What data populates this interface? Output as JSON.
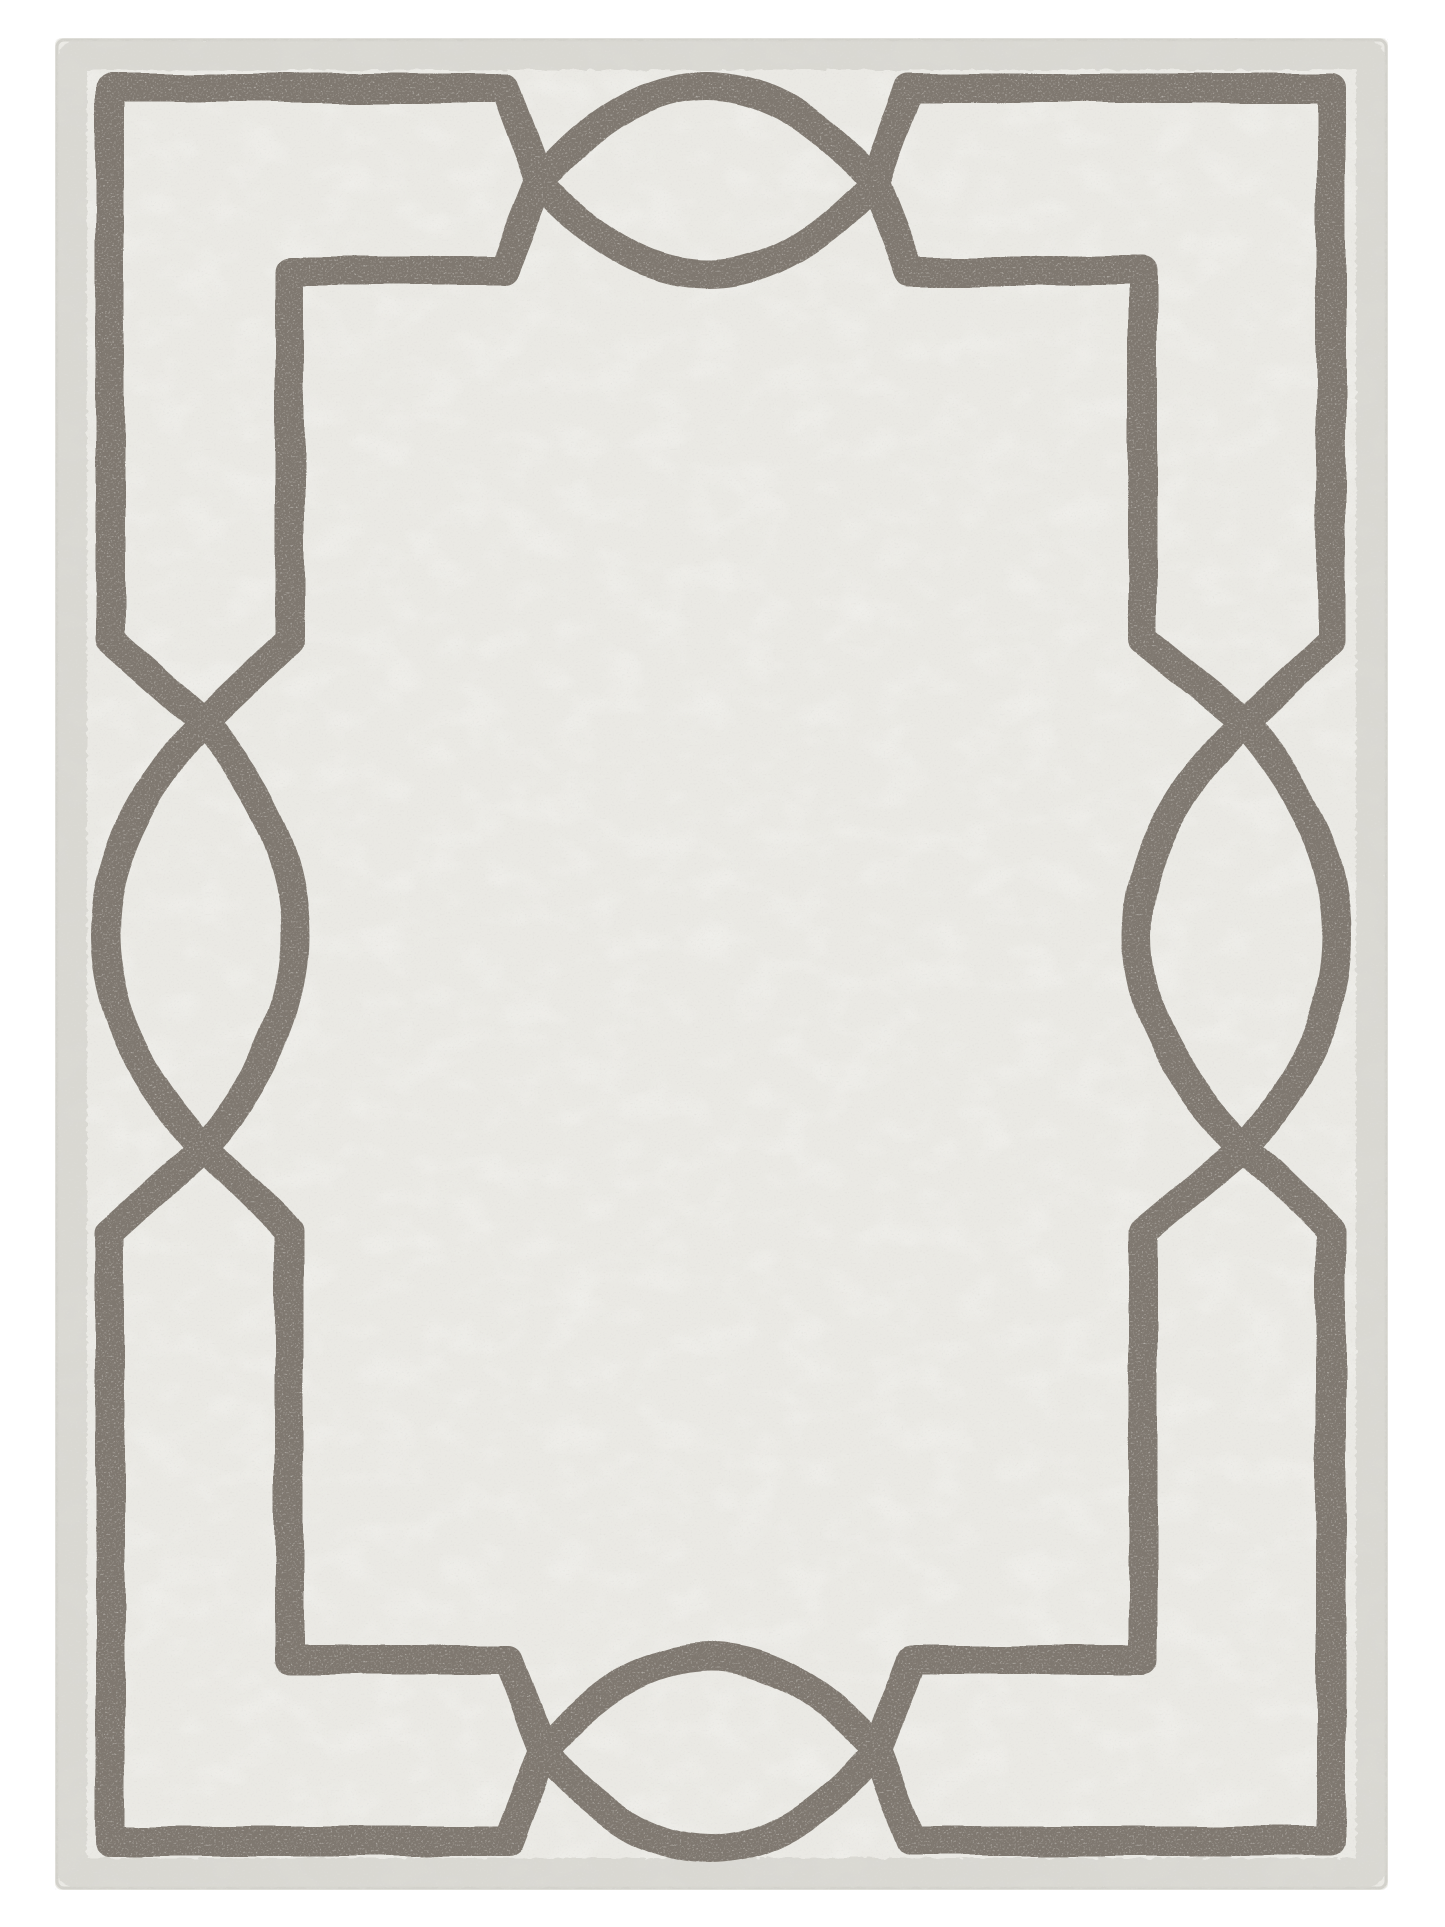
{
  "scene": {
    "type": "product-photograph",
    "subject": "rectangular hand-hooked area rug, top-down view",
    "background_color": "#ffffff"
  },
  "rug": {
    "field_color": "#eae9e4",
    "speckle_color": "#bdbab3",
    "blotch_color": "#ffffff",
    "selvage_color": "#d7d6d0",
    "edge_line_color": "#cfcec8",
    "border_color": "#7f7870",
    "pattern": "double rectangular frame border with interlocking pointed-oval (lens) motifs centered on each side"
  }
}
